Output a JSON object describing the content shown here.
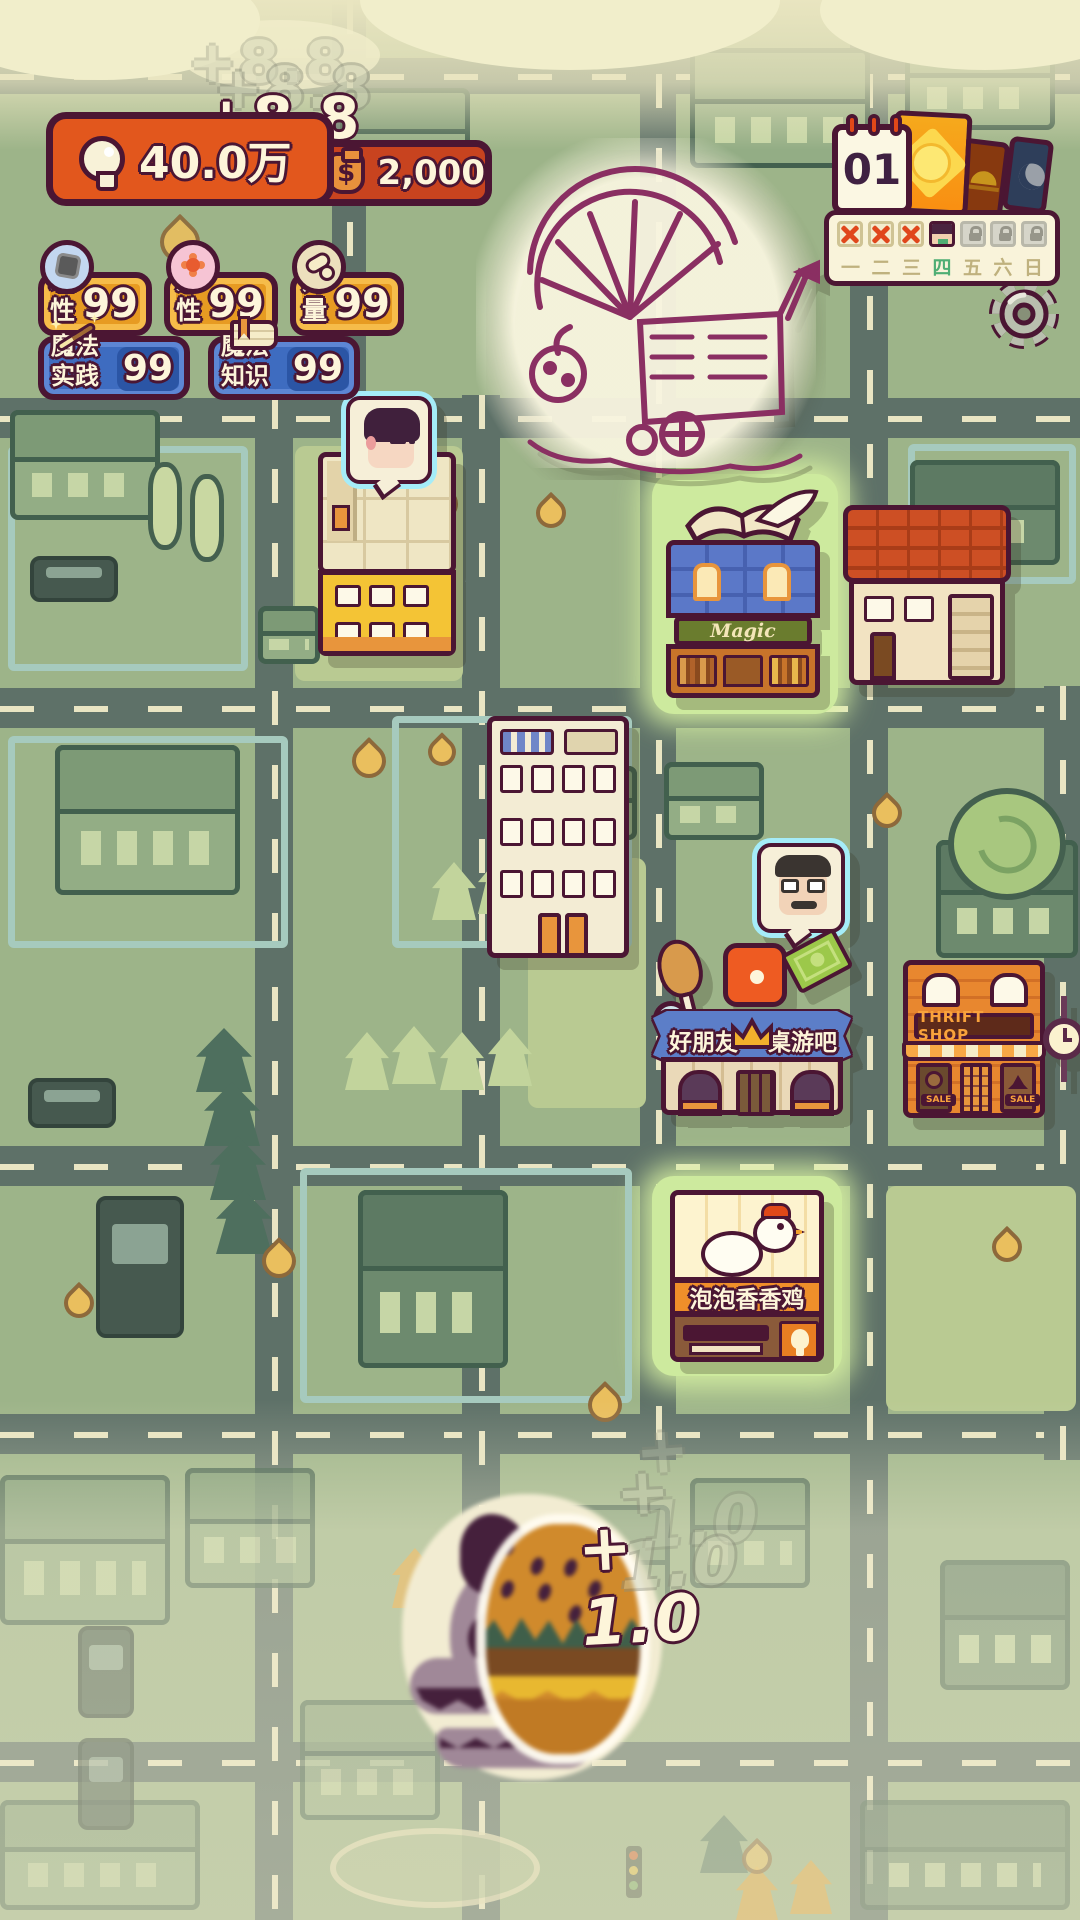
{
  "colors": {
    "accent_orange": "#e2571d",
    "pill_gold": "#e79b22",
    "pill_blue": "#3e6cc0",
    "outline": "#4b1633",
    "x_red": "#e0471c",
    "active_day_green": "#4fae74"
  },
  "hud": {
    "insight": {
      "value": "40.0万",
      "gain_popup": "+8.8"
    },
    "money": {
      "value": "2,000",
      "currency_symbol": "$"
    },
    "stats": [
      {
        "label": "理性",
        "value": "99",
        "icon": "rational-head-icon"
      },
      {
        "label": "感性",
        "value": "99",
        "icon": "emotion-head-icon"
      },
      {
        "label": "力量",
        "value": "99",
        "icon": "strength-arm-icon"
      }
    ],
    "magic_stats": [
      {
        "label": "魔法实践",
        "value": "99",
        "icon": "magic-wand-icon"
      },
      {
        "label": "魔法知识",
        "value": "99",
        "icon": "magic-book-icon"
      }
    ]
  },
  "calendar": {
    "day_number": "01",
    "phase_cards": [
      "sun-card",
      "dusk-card",
      "moon-card"
    ],
    "week_slots": [
      "x",
      "x",
      "x",
      "avatar",
      "lock",
      "lock",
      "lock"
    ],
    "day_labels": [
      "一",
      "二",
      "三",
      "四",
      "五",
      "六",
      "日"
    ],
    "active_day": "四"
  },
  "buildings": {
    "magic_shop_sign": "Magic",
    "boardgame_sign_left": "好朋友",
    "boardgame_sign_right": "桌游吧",
    "thrift_sign": "THRIFT SHOP",
    "sale_tag": "SALE",
    "chicken_sign": "泡泡香香鸡"
  },
  "popups": {
    "burger_gain": "+ 1.0"
  }
}
